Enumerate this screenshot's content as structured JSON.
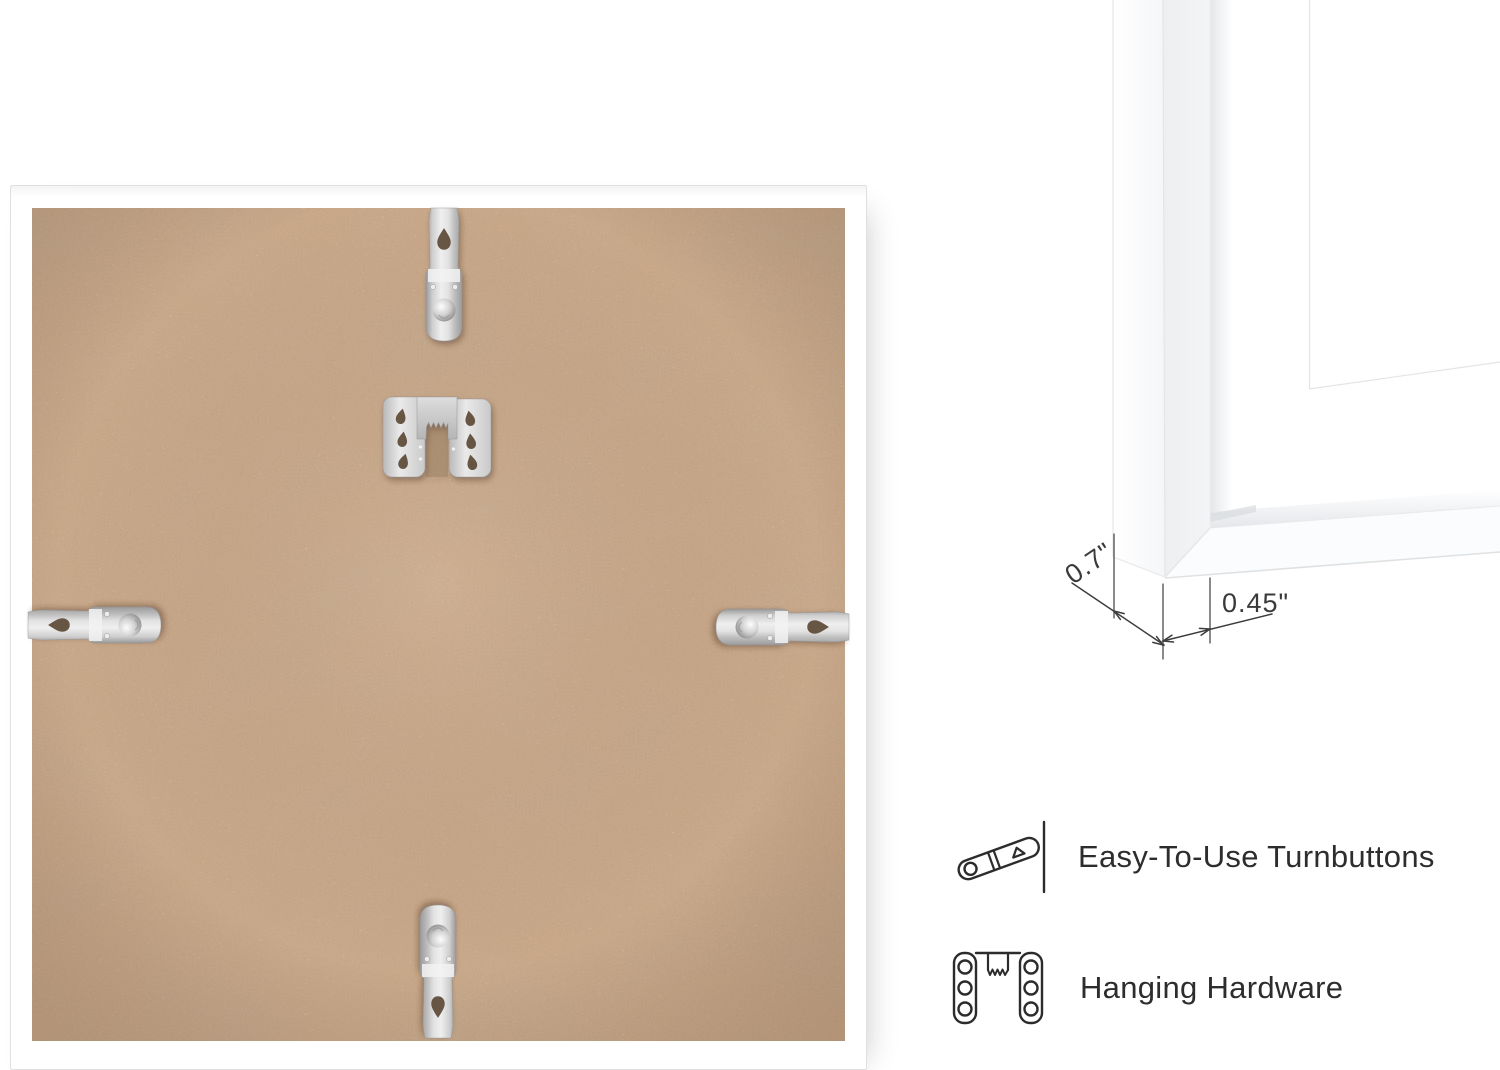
{
  "scene": {
    "type": "product-photo",
    "background": "#ffffff"
  },
  "photo": {
    "frame_color": "#ffffff",
    "backboard_color": "#cba98a",
    "hardware_metal_color": "#cfcfcf",
    "hardware": [
      "turnbutton-top",
      "turnbutton-left",
      "turnbutton-right",
      "turnbutton-bottom",
      "sawtooth-hanger"
    ]
  },
  "closeup": {
    "depth_label": "0.7\"",
    "face_label": "0.45\"",
    "line_color": "#3d3d3d"
  },
  "features": [
    {
      "icon": "turnbutton-icon",
      "label": "Easy-To-Use Turnbuttons"
    },
    {
      "icon": "hanging-hardware-icon",
      "label": "Hanging Hardware"
    }
  ],
  "text_color": "#2d2d2d"
}
